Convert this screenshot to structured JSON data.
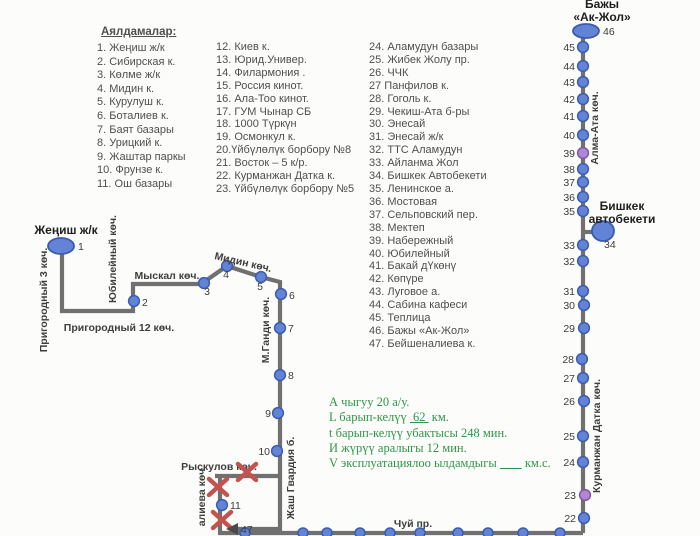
{
  "list": {
    "header": "Аялдамалар:",
    "columns": [
      [
        "1. Жеңиш ж/к",
        "2. Сибирская к.",
        "3. Көлме ж/к",
        "4. Мидин к.",
        "5. Курулуш к.",
        "6. Боталиев к.",
        "7. Баят базары",
        "8. Урицкий к.",
        "9. Жаштар паркы",
        "10. Фрунзе к.",
        "11. Ош базары"
      ],
      [
        "12. Киев к.",
        "13. Юрид.Универ.",
        "14. Филармония .",
        "15. Россия кинот.",
        "16. Ала-Тоо кинот.",
        "17. ГУМ Чынар СБ",
        "18. 1000 Түркүн",
        "19. Осмонкул к.",
        "20.Үйбүлөлүк борбору №8",
        "21. Восток – 5 к/р.",
        "22. Курманжан Датка к.",
        "23. Үйбүлөлүк борбору №5"
      ],
      [
        "24. Аламудун базары",
        "25. Жибек Жолу пр.",
        "26. ЧЧК",
        "27 Панфилов к.",
        "28. Гоголь к.",
        "29. Чекиш-Ата б-ры",
        "30. Энесай",
        "31. Энесай ж/к",
        "32. ТТС Аламудун",
        "33. Айланма Жол",
        "34. Бишкек Автобекети",
        "35. Ленинское а.",
        "36. Мостовая",
        "37. Сельповский пер.",
        "38. Мектеп",
        "39. Набережный",
        "40. Юбилейный",
        "41. Бакай дҮкөнү",
        "42. Көпүре",
        "43. Луговое а.",
        "44. Сабина кафеси",
        "45. Теплица",
        "46. Бажы «Ак-Жол»",
        "47. Бейшеналиева к."
      ]
    ]
  },
  "notes": {
    "lines": [
      {
        "text": "А чыгуу 20 а/у."
      },
      {
        "pre": "L барып-келүү ",
        "u": " 62 ",
        "post": " км."
      },
      {
        "text": "t барып-келүү убактысы 248 мин."
      },
      {
        "text": "И жүрүү аралыгы  12  мин."
      },
      {
        "pre": "V эксплуатациялоо ылдамдыгы ",
        "u": "       ",
        "post": " км.с."
      }
    ]
  },
  "map": {
    "colors": {
      "line": "#707070",
      "stop_fill": "#6283d6",
      "stop_stroke": "#3b5cae",
      "alt_fill": "#b287d2",
      "alt_stroke": "#7e57a8",
      "cross": "#c4524e",
      "number": "#3c3c3c",
      "street": "#3e3e3e",
      "title": "#1f1f1f"
    },
    "paths": [
      {
        "name": "left-route-line",
        "d": "M62,252 L62,311 L133,311 L133,284 L201,284 L227,266 L261,277 L280,282 L280,533"
      },
      {
        "name": "right-route-line",
        "d": "M583,38 L583,533"
      },
      {
        "name": "chui-route-line",
        "d": "M218,533 L583,533"
      },
      {
        "name": "bus-station-branch-line",
        "d": "M583,232 L599,232"
      },
      {
        "name": "ryskulov-branch-line",
        "d": "M215,476 L280,476"
      },
      {
        "name": "beishenalieva-line",
        "d": "M220,476 L220,533"
      },
      {
        "name": "stop47-line",
        "d": "M236,529 L280,529"
      }
    ],
    "terminals": [
      {
        "num": "1",
        "cx": 61,
        "cy": 246,
        "rx": 13,
        "ry": 8,
        "num_x": 78,
        "num_y": 250,
        "title": [
          "Жеңиш ж/к"
        ],
        "tx": 66,
        "ty": 234
      },
      {
        "num": "46",
        "cx": 586,
        "cy": 31,
        "rx": 13,
        "ry": 7,
        "num_x": 603,
        "num_y": 35,
        "title": [
          "Бажы",
          "«Ак-Жол»"
        ],
        "tx": 602,
        "ty": 8
      },
      {
        "num": "34",
        "cx": 603,
        "cy": 231,
        "rx": 11,
        "ry": 10,
        "num_x": 604,
        "num_y": 248,
        "title": [
          "Бишкек",
          "автобекети"
        ],
        "tx": 622,
        "ty": 210
      }
    ],
    "stops": [
      {
        "num": "2",
        "x": 134,
        "y": 301,
        "lx": 142,
        "ly": 306,
        "anchor": "start"
      },
      {
        "num": "3",
        "x": 204,
        "y": 283,
        "lx": 207,
        "ly": 295,
        "anchor": "middle"
      },
      {
        "num": "4",
        "x": 227,
        "y": 266,
        "lx": 226,
        "ly": 278,
        "anchor": "middle"
      },
      {
        "num": "5",
        "x": 261,
        "y": 277,
        "lx": 260,
        "ly": 290,
        "anchor": "middle"
      },
      {
        "num": "6",
        "x": 281,
        "y": 294,
        "lx": 289,
        "ly": 299,
        "anchor": "start"
      },
      {
        "num": "7",
        "x": 280,
        "y": 328,
        "lx": 288,
        "ly": 332,
        "anchor": "start"
      },
      {
        "num": "8",
        "x": 280,
        "y": 375,
        "lx": 288,
        "ly": 379,
        "anchor": "start"
      },
      {
        "num": "9",
        "x": 278,
        "y": 413,
        "lx": 271,
        "ly": 417,
        "anchor": "end"
      },
      {
        "num": "10",
        "x": 277,
        "y": 451,
        "lx": 270,
        "ly": 455,
        "anchor": "end"
      },
      {
        "num": "11",
        "x": 222,
        "y": 505,
        "lx": 230,
        "ly": 509,
        "anchor": "start"
      },
      {
        "num": "22",
        "x": 584,
        "y": 518,
        "lx": 576,
        "ly": 522,
        "anchor": "end"
      },
      {
        "num": "23",
        "x": 585,
        "y": 495,
        "lx": 576,
        "ly": 499,
        "anchor": "end",
        "variant": "alt"
      },
      {
        "num": "24",
        "x": 583,
        "y": 462,
        "lx": 575,
        "ly": 466,
        "anchor": "end"
      },
      {
        "num": "25",
        "x": 583,
        "y": 436,
        "lx": 575,
        "ly": 440,
        "anchor": "end"
      },
      {
        "num": "26",
        "x": 584,
        "y": 401,
        "lx": 575,
        "ly": 405,
        "anchor": "end"
      },
      {
        "num": "27",
        "x": 583,
        "y": 378,
        "lx": 575,
        "ly": 382,
        "anchor": "end"
      },
      {
        "num": "28",
        "x": 582,
        "y": 359,
        "lx": 574,
        "ly": 363,
        "anchor": "end"
      },
      {
        "num": "29",
        "x": 584,
        "y": 328,
        "lx": 575,
        "ly": 332,
        "anchor": "end"
      },
      {
        "num": "30",
        "x": 584,
        "y": 305,
        "lx": 575,
        "ly": 309,
        "anchor": "end"
      },
      {
        "num": "31",
        "x": 583,
        "y": 291,
        "lx": 575,
        "ly": 295,
        "anchor": "end"
      },
      {
        "num": "32",
        "x": 583,
        "y": 261,
        "lx": 575,
        "ly": 265,
        "anchor": "end"
      },
      {
        "num": "33",
        "x": 583,
        "y": 245,
        "lx": 575,
        "ly": 249,
        "anchor": "end"
      },
      {
        "num": "35",
        "x": 583,
        "y": 211,
        "lx": 575,
        "ly": 215,
        "anchor": "end"
      },
      {
        "num": "36",
        "x": 583,
        "y": 197,
        "lx": 575,
        "ly": 201,
        "anchor": "end"
      },
      {
        "num": "37",
        "x": 583,
        "y": 182,
        "lx": 575,
        "ly": 186,
        "anchor": "end"
      },
      {
        "num": "38",
        "x": 583,
        "y": 169,
        "lx": 575,
        "ly": 173,
        "anchor": "end"
      },
      {
        "num": "39",
        "x": 583,
        "y": 153,
        "lx": 575,
        "ly": 157,
        "anchor": "end",
        "variant": "alt"
      },
      {
        "num": "40",
        "x": 583,
        "y": 135,
        "lx": 575,
        "ly": 139,
        "anchor": "end"
      },
      {
        "num": "41",
        "x": 583,
        "y": 116,
        "lx": 575,
        "ly": 120,
        "anchor": "end"
      },
      {
        "num": "42",
        "x": 583,
        "y": 99,
        "lx": 575,
        "ly": 103,
        "anchor": "end"
      },
      {
        "num": "43",
        "x": 583,
        "y": 82,
        "lx": 575,
        "ly": 86,
        "anchor": "end"
      },
      {
        "num": "44",
        "x": 583,
        "y": 66,
        "lx": 575,
        "ly": 70,
        "anchor": "end"
      },
      {
        "num": "45",
        "x": 583,
        "y": 47,
        "lx": 575,
        "ly": 51,
        "anchor": "end"
      }
    ],
    "plain_dots_y": 533,
    "plain_dots_x": [
      245,
      303,
      327,
      360,
      390,
      420,
      458,
      488,
      523,
      560
    ],
    "streets": [
      {
        "text": "Пригородный 3 көч.",
        "x": 47,
        "y": 300,
        "rot": -90
      },
      {
        "text": "Юбилейный көч.",
        "x": 116,
        "y": 259,
        "rot": -90
      },
      {
        "text": "Пригородный 12 көч.",
        "x": 119,
        "y": 331,
        "rot": 0
      },
      {
        "text": "Мыскал көч.",
        "x": 167,
        "y": 279,
        "rot": 0
      },
      {
        "text": "Мидин көч.",
        "x": 214,
        "y": 259,
        "rot": 13,
        "anchor": "start"
      },
      {
        "text": "М.Ганди көч.",
        "x": 269,
        "y": 330,
        "rot": -90
      },
      {
        "text": "Жаш Гвардия б.",
        "x": 294,
        "y": 478,
        "rot": -90
      },
      {
        "text": "алиева көч.",
        "x": 205,
        "y": 496,
        "rot": -90
      },
      {
        "text": "Рыскулов көч.",
        "x": 219,
        "y": 470,
        "rot": 0
      },
      {
        "text": "Чуй пр.",
        "x": 413,
        "y": 527,
        "rot": 0
      },
      {
        "text": "Алма-Ата көч.",
        "x": 598,
        "y": 128,
        "rot": -90
      },
      {
        "text": "Курманжан Датка көч.",
        "x": 600,
        "y": 436,
        "rot": -90
      }
    ],
    "crosses": [
      {
        "x": 247,
        "y": 472
      },
      {
        "x": 218,
        "y": 487
      },
      {
        "x": 222,
        "y": 520
      }
    ],
    "arrow47": {
      "label": "47",
      "points": "226,529 238,523 238,535",
      "line_y": 529,
      "text_x": 241,
      "text_y": 533
    }
  }
}
